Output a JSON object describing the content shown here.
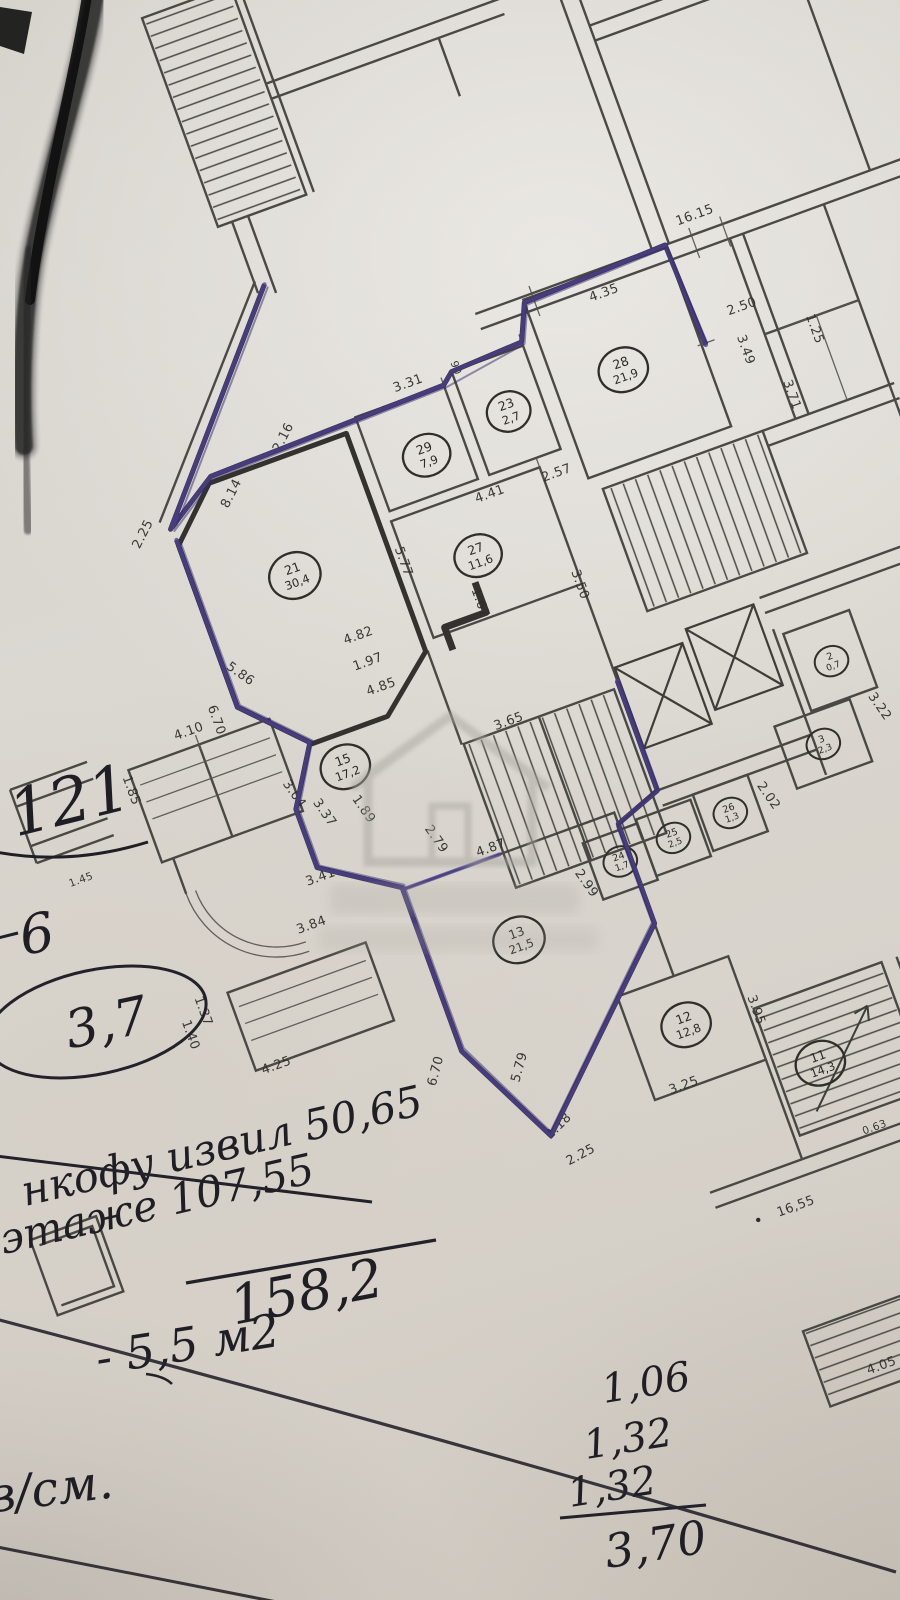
{
  "plan": {
    "colors": {
      "ink": "#3c3b38",
      "pen_blue": "#4b3f96",
      "paper": "#d8d5cf"
    },
    "dims": [
      {
        "t": "2.25"
      },
      {
        "t": "8.14"
      },
      {
        "t": "2.16"
      },
      {
        "t": "3.31"
      },
      {
        "t": "90"
      },
      {
        "t": "4.35"
      },
      {
        "t": "16.15"
      },
      {
        "t": "2.50"
      },
      {
        "t": "3.49"
      },
      {
        "t": "3.71"
      },
      {
        "t": "1.25"
      },
      {
        "t": "5.77"
      },
      {
        "t": "4.41"
      },
      {
        "t": "2.57"
      },
      {
        "t": "3.50"
      },
      {
        "t": "1.67"
      },
      {
        "t": "4.82"
      },
      {
        "t": "1.97"
      },
      {
        "t": "4.85"
      },
      {
        "t": "5.86"
      },
      {
        "t": "6.70"
      },
      {
        "t": "4.10"
      },
      {
        "t": "1.85"
      },
      {
        "t": "1.45"
      },
      {
        "t": "3.04"
      },
      {
        "t": "3.37"
      },
      {
        "t": "3.65"
      },
      {
        "t": "1.89"
      },
      {
        "t": "2.79"
      },
      {
        "t": "2.99"
      },
      {
        "t": "3.41"
      },
      {
        "t": "3.84"
      },
      {
        "t": "1.37"
      },
      {
        "t": "1.40"
      },
      {
        "t": "4.25"
      },
      {
        "t": "4.87"
      },
      {
        "t": "5.79"
      },
      {
        "t": "6.70"
      },
      {
        "t": "2.18"
      },
      {
        "t": "2.25"
      },
      {
        "t": "3.25"
      },
      {
        "t": "3.95"
      },
      {
        "t": "2.02"
      },
      {
        "t": "3.22"
      },
      {
        "t": "0.63"
      },
      {
        "t": "16,55"
      },
      {
        "t": "4.05"
      }
    ],
    "rooms": [
      {
        "num": "21",
        "area": "30,4"
      },
      {
        "num": "29",
        "area": "7,9"
      },
      {
        "num": "23",
        "area": "2,7"
      },
      {
        "num": "28",
        "area": "21,9"
      },
      {
        "num": "27",
        "area": "11,6"
      },
      {
        "num": "15",
        "area": "17,2"
      },
      {
        "num": "13",
        "area": "21,5"
      },
      {
        "num": "12",
        "area": "12,8"
      },
      {
        "num": "11",
        "area": "14,3"
      }
    ],
    "small_rooms": [
      {
        "num": "24",
        "area": "1,7"
      },
      {
        "num": "25",
        "area": "2,5"
      },
      {
        "num": "26",
        "area": "1,3"
      },
      {
        "num": "3",
        "area": "2,3"
      },
      {
        "num": "2",
        "area": "0,7"
      }
    ]
  },
  "handwriting": {
    "big_number": "121",
    "side_number": "6",
    "oval_value": "3,7",
    "note_line1": "нкофу извил 50,65",
    "note_line2": "этаже 107,55",
    "sum_total": "158,2",
    "minus_note": "- 5,5 м2",
    "bottom_left": "в/см.",
    "column": [
      {
        "t": "1,06"
      },
      {
        "t": "1,32"
      },
      {
        "t": "1,32"
      }
    ],
    "column_total": "3,70"
  }
}
